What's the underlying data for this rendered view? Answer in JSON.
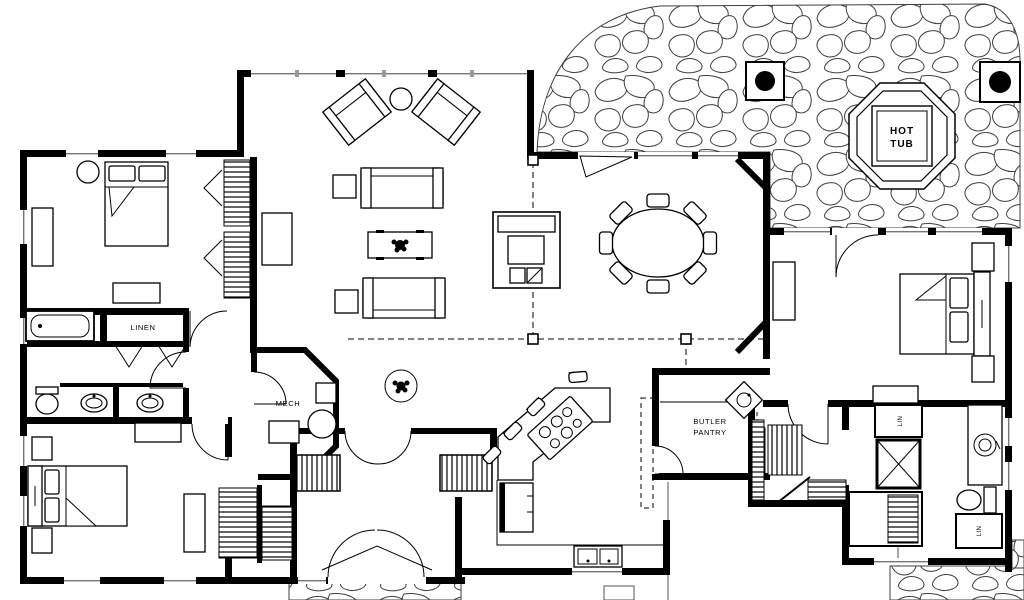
{
  "colors": {
    "background": "#ffffff",
    "ink": "#000000",
    "stone_outline": "#3f3f3f"
  },
  "labels": {
    "hot_tub_line1": "HOT",
    "hot_tub_line2": "TUB",
    "linen": "LINEN",
    "mech": "MECH",
    "butler_pantry_line1": "BUTLER",
    "butler_pantry_line2": "PANTRY",
    "lin_closet_upper": "LIN",
    "lin_closet_lower": "LIN"
  }
}
